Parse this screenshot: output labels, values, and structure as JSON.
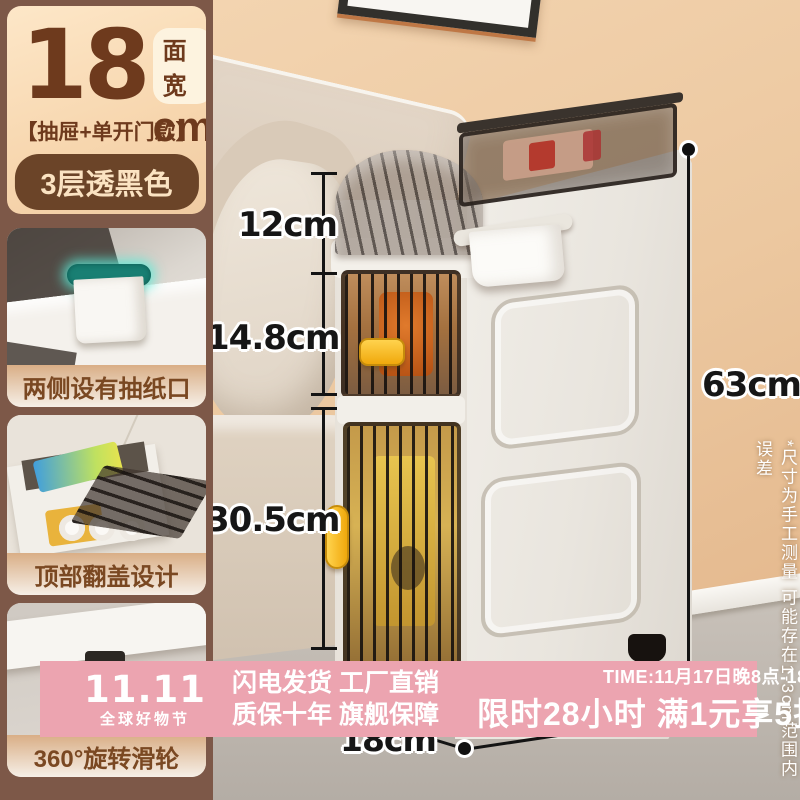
{
  "panel": {
    "width_value": "18",
    "width_badge": "面宽",
    "width_unit": "cm",
    "variant": "【抽屉+单开门款】",
    "color_option": "3层透黑色",
    "features": [
      {
        "label": "两侧设有抽纸口"
      },
      {
        "label": "顶部翻盖设计"
      },
      {
        "label": "360°旋转滑轮"
      }
    ]
  },
  "measurements": {
    "lid_height": "12cm",
    "drawer_height": "14.8cm",
    "door_height": "30.5cm",
    "total_height": "63cm",
    "depth": "18cm"
  },
  "disclaimer": {
    "text": "*尺寸为手工测量 可能存在1-3cm范围内误差"
  },
  "banner": {
    "logo_main": "11.11",
    "logo_sub": "全球好物节",
    "slogan_line1": "闪电发货 工厂直销",
    "slogan_line2": "质保十年 旗舰保障",
    "time": "TIME:11月17日晚8点-18日",
    "promo": "限时28小时 满1元享5折"
  },
  "colors": {
    "banner_pink": "#eca4b0",
    "panel_brown": "#7d5848",
    "text_brown": "#6e3a1d",
    "card_tan": "#f7d6ae",
    "handle_yellow": "#f0a80c"
  }
}
